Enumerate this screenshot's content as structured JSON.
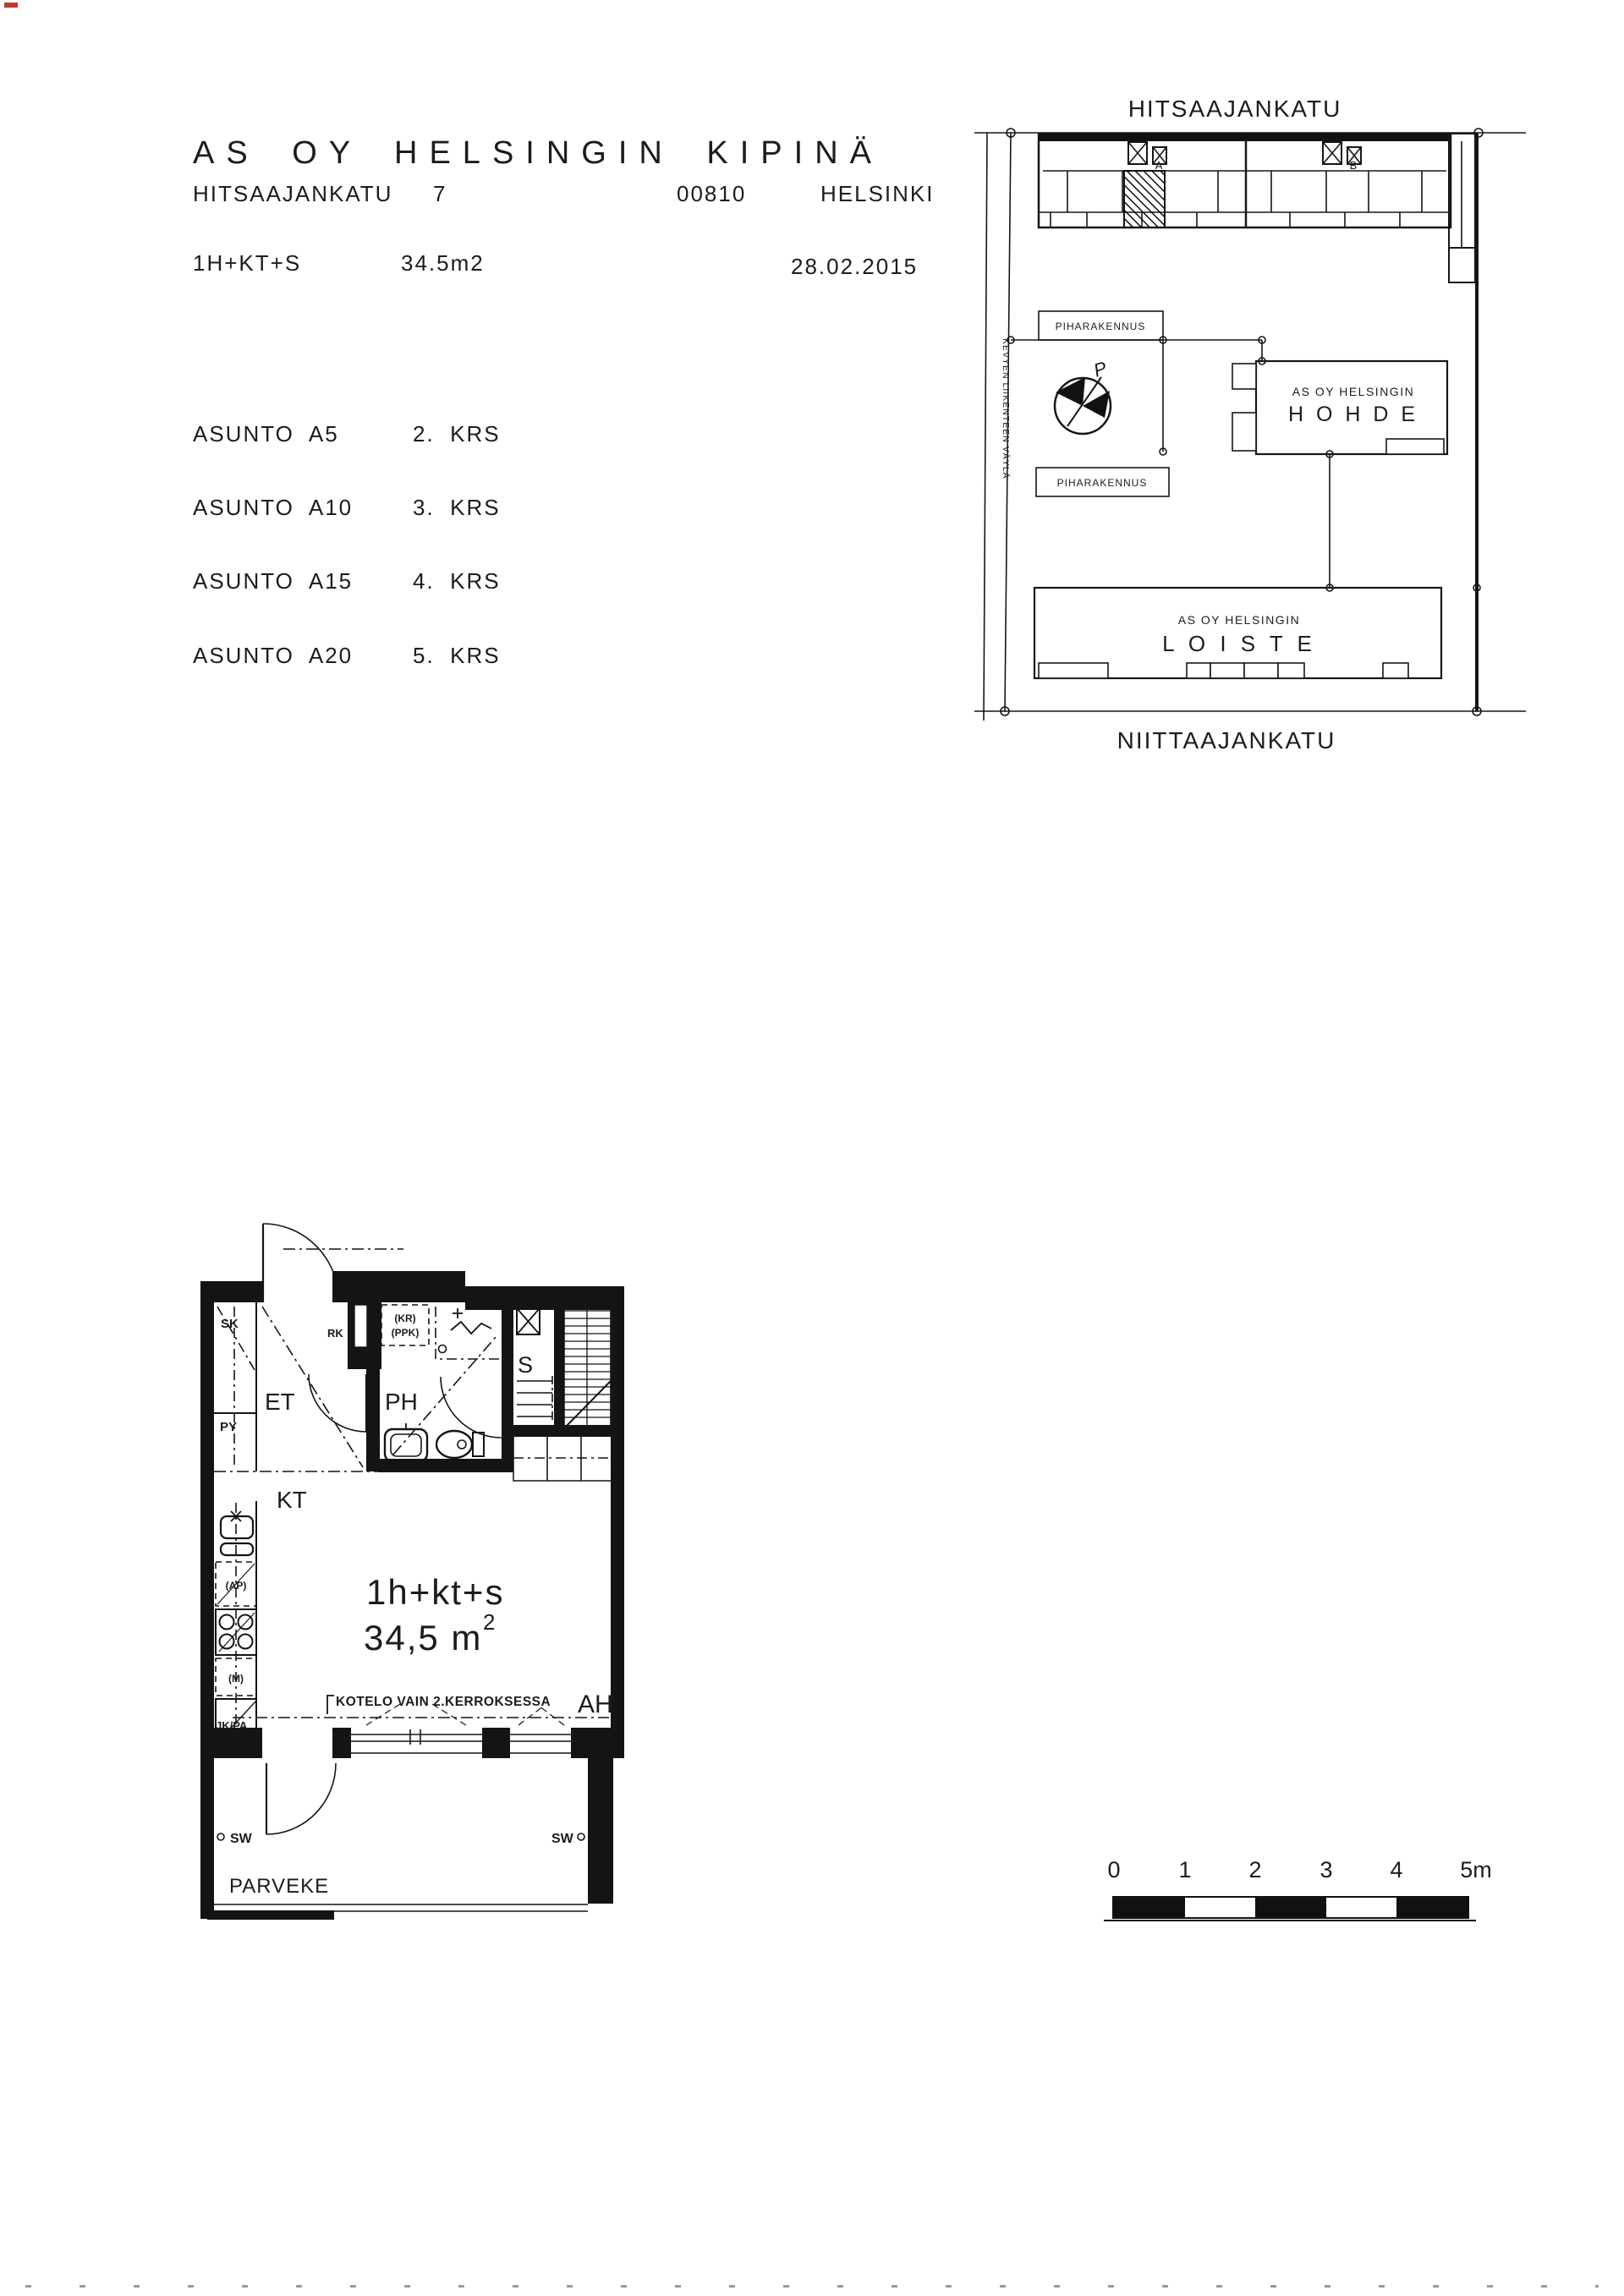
{
  "header": {
    "title": "AS OY HELSINGIN KIPINÄ",
    "street": "HITSAAJANKATU",
    "street_number": "7",
    "postal_code": "00810",
    "city": "HELSINKI",
    "apartment_type": "1H+KT+S",
    "area": "34.5m2",
    "date": "28.02.2015"
  },
  "apartments": [
    {
      "name": "ASUNTO  A5",
      "floor": "2.  KRS"
    },
    {
      "name": "ASUNTO  A10",
      "floor": "3.  KRS"
    },
    {
      "name": "ASUNTO  A15",
      "floor": "4.  KRS"
    },
    {
      "name": "ASUNTO  A20",
      "floor": "5.  KRS"
    }
  ],
  "site_plan": {
    "street_top": "HITSAAJANKATU",
    "street_bottom": "NIITTAAJANKATU",
    "lane_label": "KEVYEN LIIKENTEEN VÄYLÄ",
    "outbuilding_1": "PIHARAKENNUS",
    "outbuilding_2": "PIHARAKENNUS",
    "stair_a": "A",
    "stair_b": "B",
    "north_label": "P",
    "hohde_line1": "AS OY HELSINGIN",
    "hohde_line2": "H O H D E",
    "loiste_line1": "AS OY  HELSINGIN",
    "loiste_line2": "L O I S T E"
  },
  "floor_plan": {
    "sk": "SK",
    "py": "PY",
    "et": "ET",
    "rk": "RK",
    "kr": "(KR)",
    "ppk": "(PPK)",
    "ph": "PH",
    "s": "S",
    "kt": "KT",
    "ap": "(AP)",
    "m": "(M)",
    "jkpa": "JK/PA",
    "unit_type": "1h+kt+s",
    "area_label": "34,5 m",
    "area_sup": "2",
    "kotelo": "KOTELO VAIN 2.KERROKSESSA",
    "ah": "AH",
    "sw_left": "SW",
    "sw_right": "SW",
    "balcony": "PARVEKE"
  },
  "scale_bar": {
    "labels": [
      "0",
      "1",
      "2",
      "3",
      "4",
      "5m"
    ]
  }
}
